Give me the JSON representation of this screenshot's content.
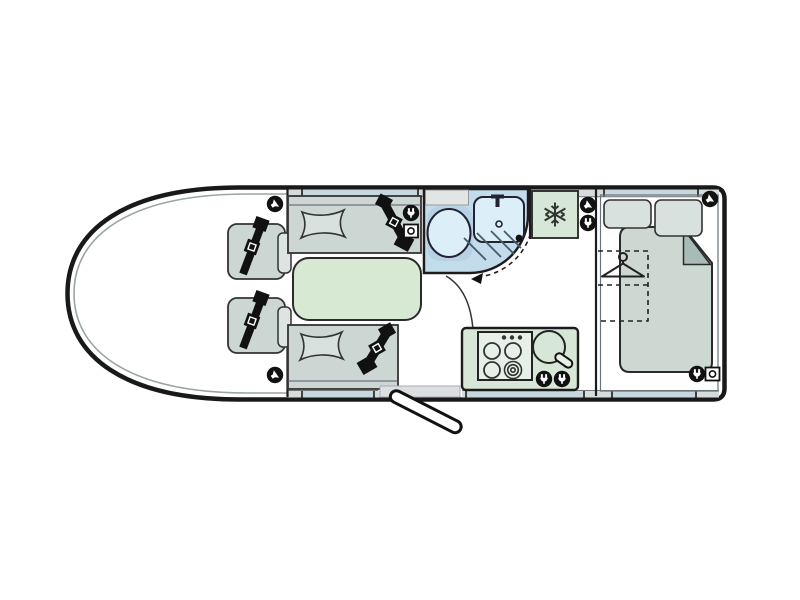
{
  "diagram": {
    "type": "motorhome-floorplan",
    "description": "Overhead floorplan of a motorhome with cab, lounge, washroom, kitchen and rear bedroom",
    "rooms": [
      "cab",
      "lounge",
      "washroom",
      "kitchen",
      "bedroom"
    ],
    "features": {
      "cab": [
        "driver-swivel-seat",
        "passenger-swivel-seat",
        "seatbelts",
        "speakers"
      ],
      "lounge": [
        "travel-seat-front",
        "travel-seat-rear",
        "seat-cushions",
        "seatbelts",
        "table",
        "mains-socket",
        "tv-point"
      ],
      "washroom": [
        "toilet",
        "washbasin-with-tap",
        "shower-drain",
        "door-swing-arc"
      ],
      "kitchen": [
        "fridge",
        "four-burner-hob",
        "hob-control-knobs",
        "round-sink-with-tap",
        "mains-sockets"
      ],
      "bedroom": [
        "double-bed-with-folded-duvet-corner",
        "two-pillows",
        "wardrobe-dashed-outline",
        "clothes-hanger",
        "speakers",
        "mains-socket",
        "tv-point"
      ],
      "entrance": [
        "entry-door-open",
        "entry-step"
      ]
    },
    "icons": [
      "speaker-icon",
      "plug-socket-icon",
      "tv-point-icon",
      "snowflake-fridge-icon",
      "hanger-icon",
      "door-swing-arrow-icon"
    ]
  },
  "colors": {
    "background": "#ffffff",
    "outline": "#191919",
    "inner_line": "#9aa4a4",
    "wall_band": "#d6dbdb",
    "window": "#c6d8dd",
    "seat": "#ccd7d3",
    "seat_back": "#dde4e1",
    "pillow": "#d8e1dd",
    "table": "#d8e9d3",
    "bathroom": "#c3dcec",
    "bathroom_dark": "#b7d2e4",
    "fixture": "#dceef7",
    "shelf": "#e2e5e5",
    "kitchen_unit": "#d7e7d7",
    "hob_panel": "#e6efe8",
    "bed": "#cdd8d3",
    "bed_fold": "#a7bbb7",
    "step": "#dcdfdf",
    "icon_black": "#111111"
  }
}
